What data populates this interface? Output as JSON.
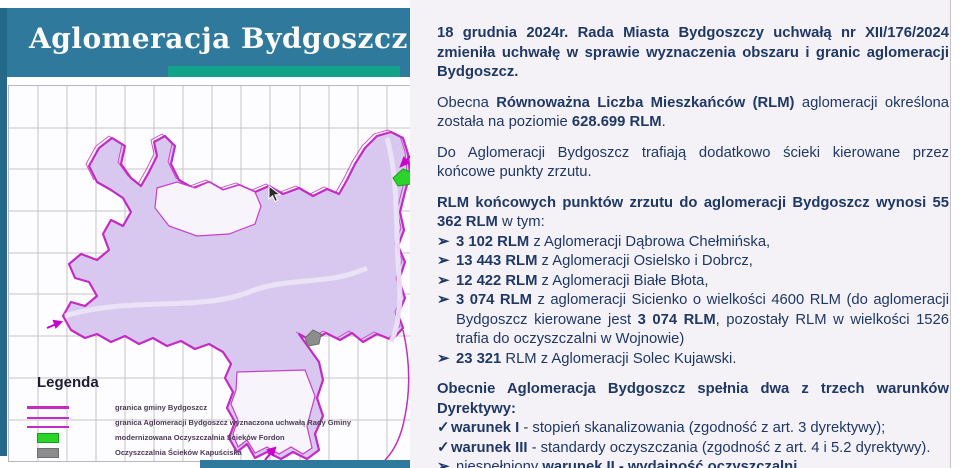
{
  "title": "Aglomeracja Bydgoszcz",
  "colors": {
    "banner_teal": "#2f7a9c",
    "accent_green": "#12a287",
    "boundary_magenta": "#c32bc3",
    "map_fill_purple": "#d8c8f0",
    "text_navy": "#1f3864",
    "plant_green": "#2bd42b",
    "plant_gray": "#8d8d8d"
  },
  "map": {
    "legend": {
      "title": "Legenda",
      "items": [
        {
          "label": "granica gminy Bydgoszcz"
        },
        {
          "label": "granica Aglomeracji Bydgoszcz wyznaczona uchwałą Rady Gminy"
        },
        {
          "label": "modernizowana Oczyszczalnia Ścieków Fordon"
        },
        {
          "label": "Oczyszczalnia Ścieków Kapuściska"
        },
        {
          "label": "końcowe punkty zrzutu ścieków z gmin ościennych"
        }
      ]
    }
  },
  "content": {
    "p1": {
      "text": "18 grudnia 2024r. Rada Miasta Bydgoszczy uchwałą nr XII/176/2024 zmieniła uchwałę w sprawie wyznaczenia obszaru i granic aglomeracji Bydgoszcz."
    },
    "p2": {
      "s0": "Obecna ",
      "s1": "Równoważna Liczba Mieszkańców (RLM)",
      "s2": " aglomeracji określona została na poziomie ",
      "s3": "628.699 RLM",
      "s4": "."
    },
    "p3": {
      "text": "Do Aglomeracji Bydgoszcz trafiają dodatkowo ścieki kierowane przez końcowe punkty zrzutu."
    },
    "p4": {
      "s0": "RLM końcowych punktów zrzutu do aglomeracji Bydgoszcz wynosi 55 362 RLM",
      "s1": " w tym:"
    },
    "bullets": [
      {
        "marker": "➢",
        "s0": "3 102 RLM",
        "s1": " z Aglomeracji Dąbrowa Chełmińska,"
      },
      {
        "marker": "➢",
        "s0": "13 443 RLM",
        "s1": " z Aglomeracji Osielsko i Dobrcz,"
      },
      {
        "marker": "➢",
        "s0": "12 422 RLM",
        "s1": " z Aglomeracji Białe Błota,"
      },
      {
        "marker": "➢",
        "s0": "3 074 RLM",
        "s1": " z aglomeracji Sicienko o wielkości 4600 RLM (do aglomeracji Bydgoszcz kierowane jest ",
        "s2": "3 074 RLM",
        "s3": ", pozostały RLM w wielkości 1526 trafia do oczyszczalni w Wojnowie)"
      },
      {
        "marker": "➢",
        "s0": "23 321",
        "s1": " RLM z Aglomeracji Solec Kujawski."
      }
    ],
    "p5": {
      "text": "Obecnie Aglomeracja Bydgoszcz spełnia dwa z trzech warunków Dyrektywy:"
    },
    "checks": [
      {
        "marker": "✓",
        "s0": "warunek I",
        "s1": " - stopień skanalizowania (zgodność z art. 3 dyrektywy);"
      },
      {
        "marker": "✓",
        "s0": "warunek III",
        "s1": "  - standardy oczyszczania (zgodność z art. 4 i 5.2 dyrektywy)."
      }
    ],
    "last": {
      "marker": "➢",
      "s0": "niespełniony ",
      "s1": "warunek II - wydajność oczyszczalni"
    }
  }
}
